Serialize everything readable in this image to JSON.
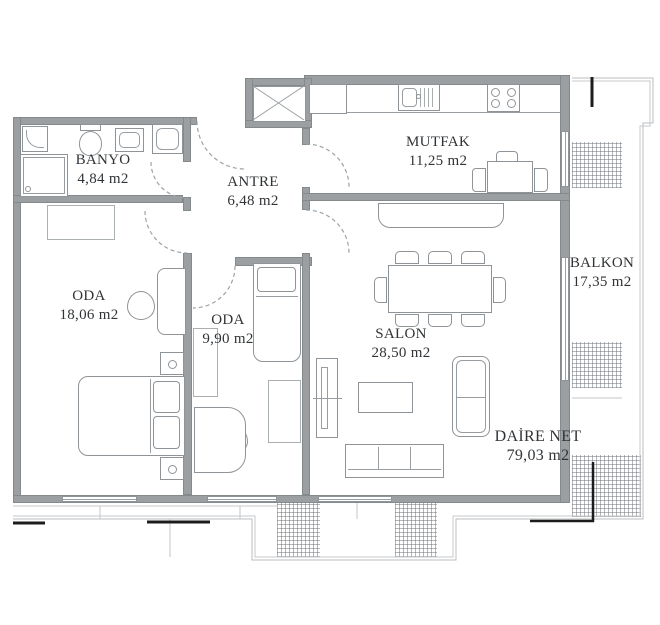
{
  "title": "apartment-floor-plan",
  "rooms": [
    {
      "id": "banyo",
      "name": "BANYO",
      "area": "4,84 m2"
    },
    {
      "id": "antre",
      "name": "ANTRE",
      "area": "6,48 m2"
    },
    {
      "id": "mutfak",
      "name": "MUTFAK",
      "area": "11,25 m2"
    },
    {
      "id": "oda-large",
      "name": "ODA",
      "area": "18,06 m2"
    },
    {
      "id": "oda-small",
      "name": "ODA",
      "area": "9,90 m2"
    },
    {
      "id": "salon",
      "name": "SALON",
      "area": "28,50 m2"
    },
    {
      "id": "balkon",
      "name": "BALKON",
      "area": "17,35 m2"
    }
  ],
  "summary": {
    "label": "DAİRE NET",
    "value": "79,03 m2"
  },
  "colors": {
    "bg": "#ffffff",
    "wall": "#9b9fa2",
    "line": "#9aa0a4",
    "outline": "#babec0",
    "text": "#313437",
    "mark": "#1c1c1c"
  }
}
